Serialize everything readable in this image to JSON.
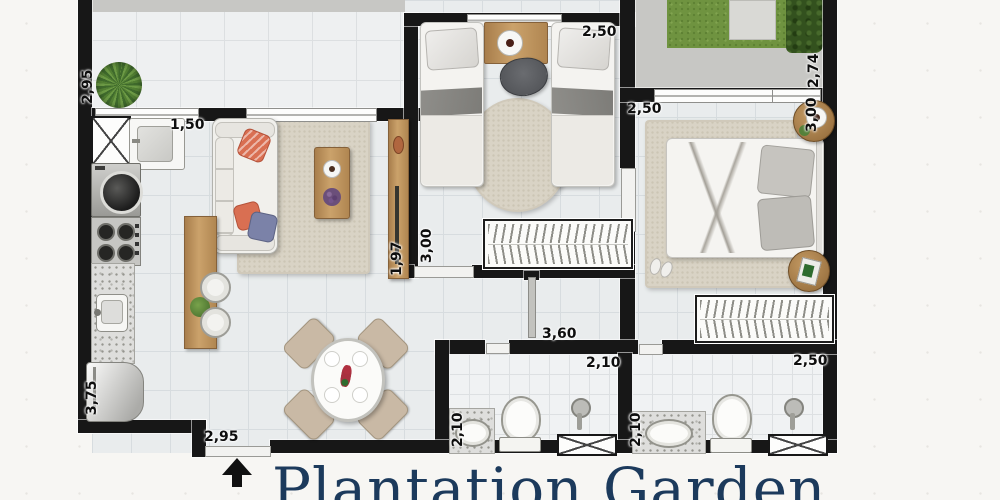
{
  "watermark": {
    "text": "Plantation Garden"
  },
  "dimensions": {
    "service_terrace_depth": "2,95",
    "kitchen_window_width": "1,50",
    "bedroom2_width": "2,50",
    "bedroom2_depth": "3,00",
    "tv_panel_length": "1,97",
    "master_bedroom_width": "2,50",
    "master_bedroom_depth": "3,00",
    "garden_depth": "2,74",
    "kitchen_depth": "3,75",
    "entrance_width": "2,95",
    "hallway_length": "3,60",
    "bathroom1_width": "2,10",
    "bathroom1_depth": "2,10",
    "bathroom2_width": "2,50",
    "bathroom2_depth": "2,10"
  },
  "colors": {
    "wall": "#171717",
    "grass": "#6f9340",
    "hedge": "#33511e",
    "wood": "#b98e58",
    "rug": "#d9d3c5",
    "watermark_navy": "#1c3a5c",
    "accent_pillow_orange": "#d96f52",
    "accent_pillow_blue": "#7b82a8"
  }
}
